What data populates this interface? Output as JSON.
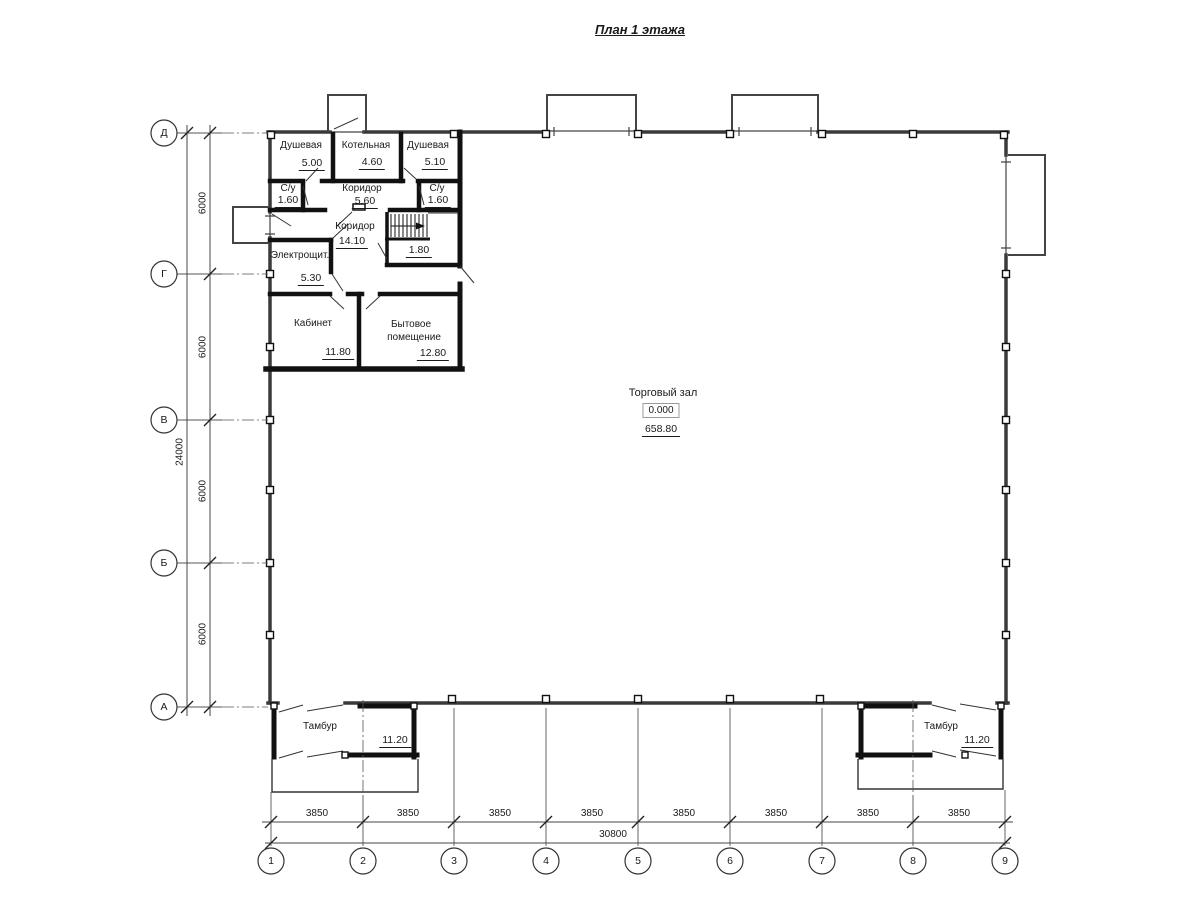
{
  "title": "План 1 этажа",
  "rooms": {
    "shower1": {
      "name": "Душевая",
      "area": "5.00"
    },
    "boiler": {
      "name": "Котельная",
      "area": "4.60"
    },
    "shower2": {
      "name": "Душевая",
      "area": "5.10"
    },
    "wc1": {
      "name": "С/у",
      "area": "1.60"
    },
    "corridor1": {
      "name": "Коридор",
      "area": "5.60"
    },
    "wc2": {
      "name": "С/у",
      "area": "1.60"
    },
    "corridor2": {
      "name": "Коридор",
      "area": "14.10"
    },
    "understairs": {
      "area": "1.80"
    },
    "electrical": {
      "name": "Электрощит.",
      "area": "5.30"
    },
    "office": {
      "name": "Кабинет",
      "area": "11.80"
    },
    "utility": {
      "name_line1": "Бытовое",
      "name_line2": "помещение",
      "area": "12.80"
    },
    "sales_hall": {
      "name": "Торговый зал",
      "level": "0.000",
      "area": "658.80"
    },
    "vestibule_left": {
      "name": "Тамбур",
      "area": "11.20"
    },
    "vestibule_right": {
      "name": "Тамбур",
      "area": "11.20"
    }
  },
  "axes": {
    "vertical": [
      "Д",
      "Г",
      "В",
      "Б",
      "А"
    ],
    "horizontal": [
      "1",
      "2",
      "3",
      "4",
      "5",
      "6",
      "7",
      "8",
      "9"
    ]
  },
  "dimensions": {
    "row_spacing": "6000",
    "total_height": "24000",
    "col_spacing": "3850",
    "total_width": "30800"
  }
}
